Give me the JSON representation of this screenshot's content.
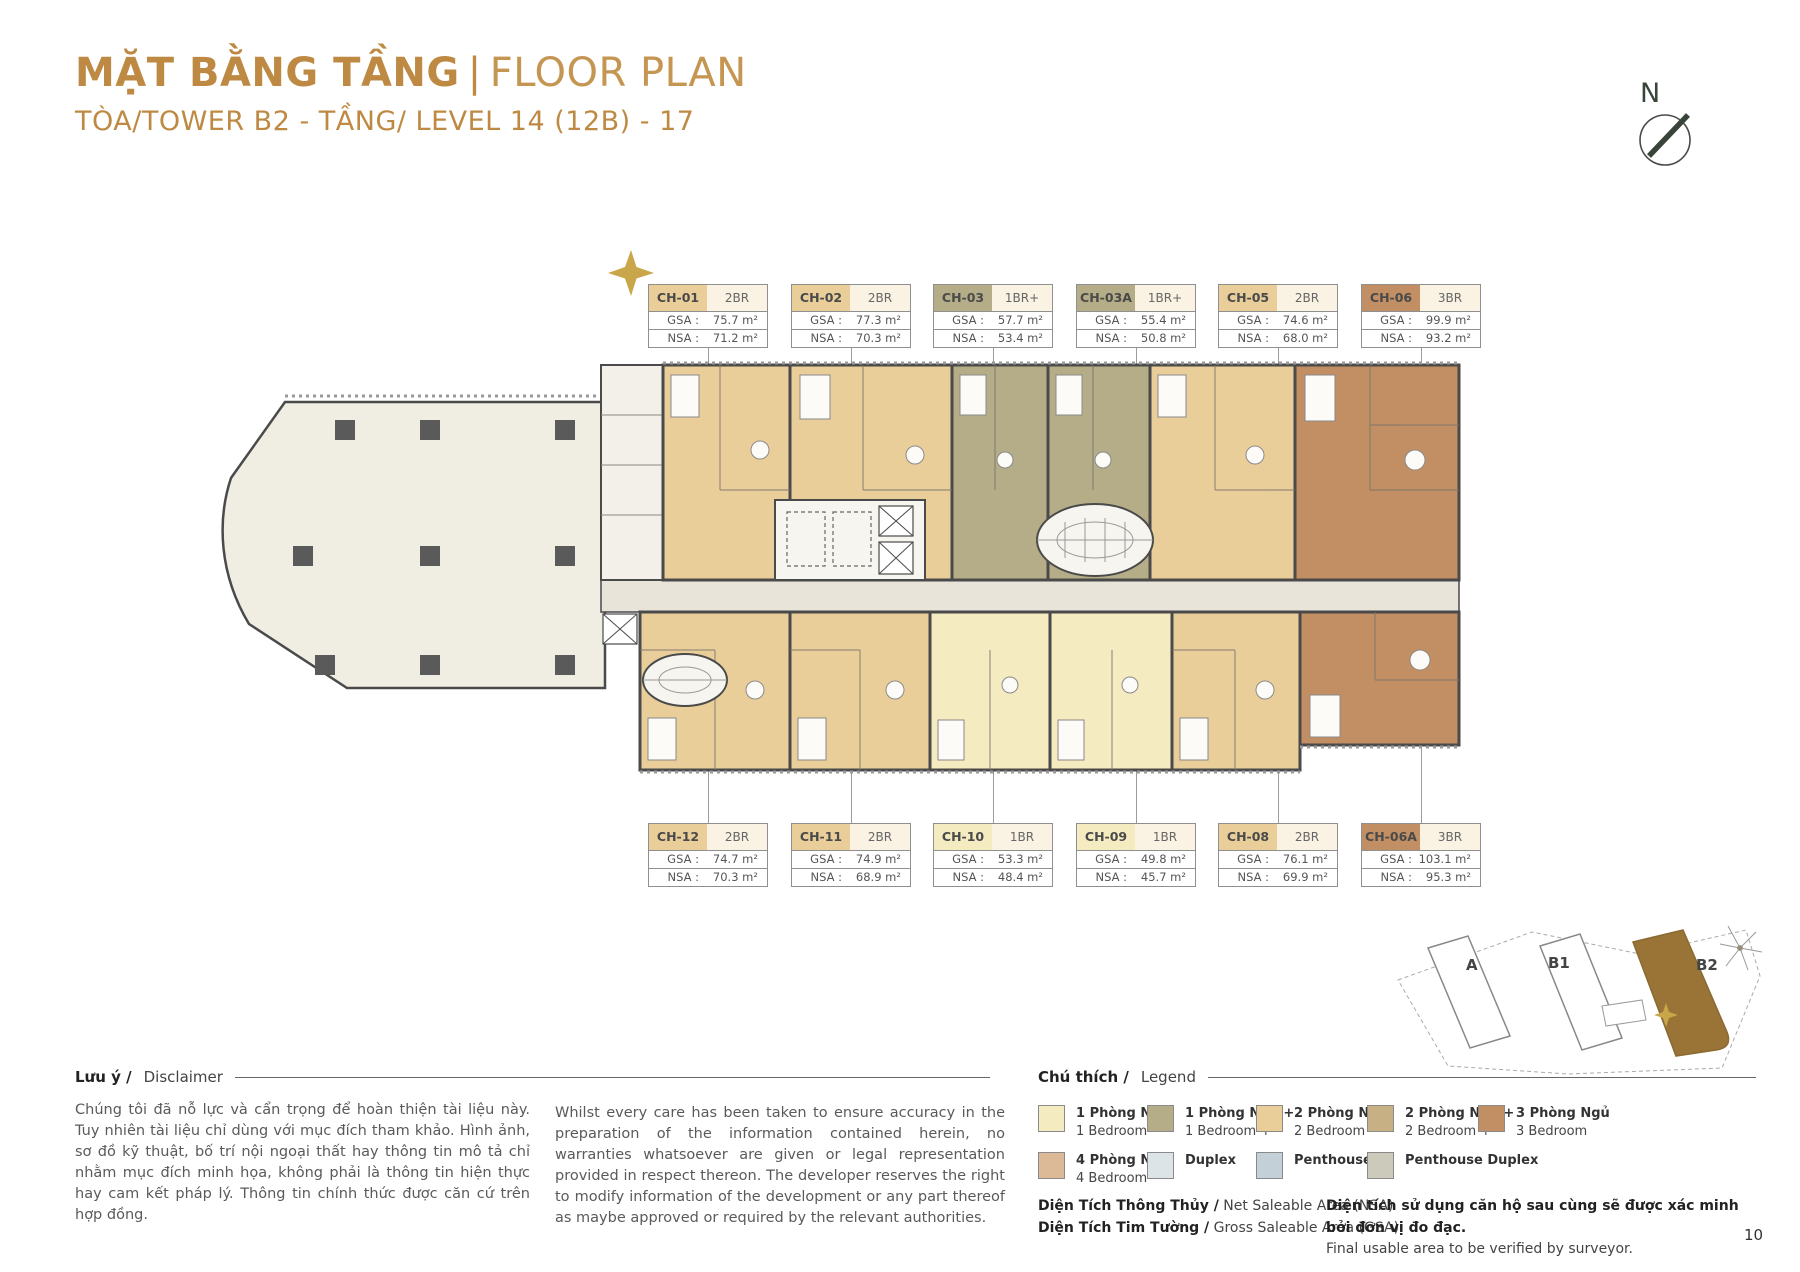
{
  "header": {
    "title_vi": "MẶT BẰNG TẦNG",
    "divider": "|",
    "title_en": "FLOOR PLAN",
    "subtitle": "TÒA/TOWER B2 - TẦNG/ LEVEL 14 (12B) - 17"
  },
  "compass": {
    "label": "N"
  },
  "labels": {
    "gsa": "GSA :",
    "nsa": "NSA :"
  },
  "units_top": [
    {
      "code": "CH-01",
      "type": "2BR",
      "gsa": "75.7 m²",
      "nsa": "71.2 m²"
    },
    {
      "code": "CH-02",
      "type": "2BR",
      "gsa": "77.3 m²",
      "nsa": "70.3 m²"
    },
    {
      "code": "CH-03",
      "type": "1BR+",
      "gsa": "57.7 m²",
      "nsa": "53.4 m²"
    },
    {
      "code": "CH-03A",
      "type": "1BR+",
      "gsa": "55.4 m²",
      "nsa": "50.8 m²"
    },
    {
      "code": "CH-05",
      "type": "2BR",
      "gsa": "74.6 m²",
      "nsa": "68.0 m²"
    },
    {
      "code": "CH-06",
      "type": "3BR",
      "gsa": "99.9 m²",
      "nsa": "93.2 m²"
    }
  ],
  "units_bottom": [
    {
      "code": "CH-12",
      "type": "2BR",
      "gsa": "74.7 m²",
      "nsa": "70.3 m²"
    },
    {
      "code": "CH-11",
      "type": "2BR",
      "gsa": "74.9 m²",
      "nsa": "68.9 m²"
    },
    {
      "code": "CH-10",
      "type": "1BR",
      "gsa": "53.3 m²",
      "nsa": "48.4 m²"
    },
    {
      "code": "CH-09",
      "type": "1BR",
      "gsa": "49.8 m²",
      "nsa": "45.7 m²"
    },
    {
      "code": "CH-08",
      "type": "2BR",
      "gsa": "76.1 m²",
      "nsa": "69.9 m²"
    },
    {
      "code": "CH-06A",
      "type": "3BR",
      "gsa": "103.1 m²",
      "nsa": "95.3 m²"
    }
  ],
  "colors": {
    "accent": "#BE8A43",
    "star": "#C9A649",
    "wall": "#4A4A4A",
    "wing": "#F0EDE3",
    "corridor": "#E8E4DA",
    "core": "#F7F5EF",
    "card_cream": "#FAF2E3",
    "bed1": "#F5EBC0",
    "bed1p": "#B5AD87",
    "bed2": "#EACE99",
    "bed2p": "#C7B184",
    "bed3": "#C18F63",
    "bed4": "#DCBA98",
    "duplex": "#DDE4E8",
    "penthouse": "#C3D0D8",
    "penthouse_duplex": "#CCCABB",
    "keyplan_brown": "#9A7336"
  },
  "keyplan": {
    "labels": [
      "A",
      "B1",
      "B2"
    ]
  },
  "disclaimer": {
    "heading_vi": "Lưu ý /",
    "heading_en": "Disclaimer",
    "vi": "Chúng tôi đã nỗ lực và cẩn trọng để hoàn thiện tài liệu này. Tuy nhiên tài liệu chỉ dùng với mục đích tham khảo. Hình ảnh, sơ đồ kỹ thuật, bố trí nội ngoại thất hay thông tin mô tả chỉ nhằm mục đích minh họa, không phải là thông tin hiện thực hay cam kết pháp lý. Thông tin chính thức được căn cứ trên hợp đồng.",
    "en": "Whilst every care has been taken to ensure accuracy in the preparation of the information contained herein, no warranties whatsoever are given or legal representation provided in respect thereon. The developer reserves the right to modify information of the development or any part thereof as maybe approved or required by the relevant authorities."
  },
  "legend": {
    "heading_vi": "Chú thích /",
    "heading_en": "Legend",
    "items": [
      {
        "vi": "1 Phòng Ngủ",
        "en": "1 Bedroom",
        "color": "bed1"
      },
      {
        "vi": "1 Phòng Ngủ +",
        "en": "1 Bedroom +",
        "color": "bed1p"
      },
      {
        "vi": "2 Phòng Ngủ",
        "en": "2 Bedroom",
        "color": "bed2"
      },
      {
        "vi": "2 Phòng Ngủ +",
        "en": "2 Bedroom +",
        "color": "bed2p"
      },
      {
        "vi": "3 Phòng Ngủ",
        "en": "3 Bedroom",
        "color": "bed3"
      },
      {
        "vi": "4 Phòng Ngủ",
        "en": "4 Bedroom",
        "color": "bed4"
      },
      {
        "vi": "Duplex",
        "en": "",
        "color": "duplex"
      },
      {
        "vi": "Penthouse",
        "en": "",
        "color": "penthouse"
      },
      {
        "vi": "Penthouse Duplex",
        "en": "",
        "color": "penthouse_duplex"
      }
    ]
  },
  "area_notes": {
    "nsa_vi": "Diện Tích Thông Thủy /",
    "nsa_en": " Net Saleable Area (NSA)",
    "gsa_vi": "Diện Tích Tim Tường /",
    "gsa_en": " Gross Saleable Area (GSA)",
    "note_vi": "Diện tích sử dụng căn hộ sau cùng sẽ được xác minh bởi đơn vị đo đạc.",
    "note_en": "Final usable area to be verified by surveyor."
  },
  "page_number": "10"
}
